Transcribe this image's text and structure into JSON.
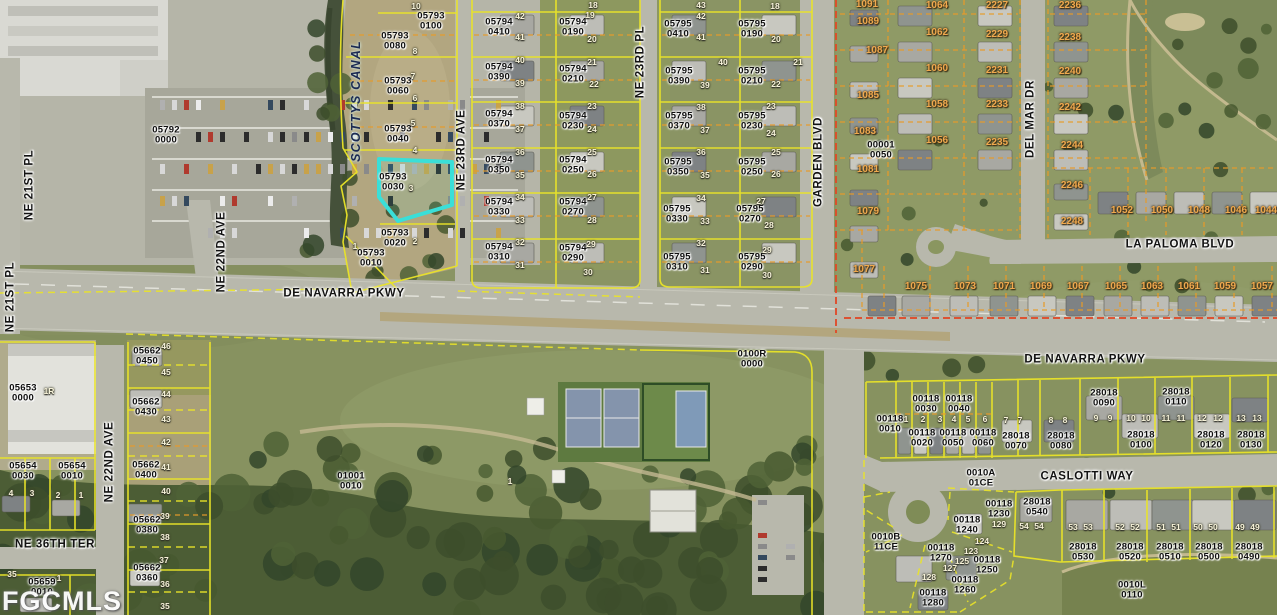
{
  "watermark": "FGCMLS",
  "highlighted_parcel": {
    "id": "05793 0030",
    "color": "#3adfd8"
  },
  "streets": [
    {
      "name": "NE 21ST PL",
      "x": 30,
      "y": 185,
      "rot": -90
    },
    {
      "name": "NE 21ST PL",
      "x": 11,
      "y": 297,
      "rot": -90
    },
    {
      "name": "NE 22ND AVE",
      "x": 222,
      "y": 252,
      "rot": -90
    },
    {
      "name": "NE 22ND AVE",
      "x": 110,
      "y": 462,
      "rot": -90
    },
    {
      "name": "NE 23RD AVE",
      "x": 462,
      "y": 150,
      "rot": -90
    },
    {
      "name": "NE 23RD PL",
      "x": 641,
      "y": 62,
      "rot": -90
    },
    {
      "name": "GARDEN BLVD",
      "x": 819,
      "y": 162,
      "rot": -90
    },
    {
      "name": "DEL MAR DR",
      "x": 1031,
      "y": 119,
      "rot": -90
    },
    {
      "name": "SCOTTYS CANAL",
      "x": 356,
      "y": 101,
      "rot": -90,
      "style": "canal"
    },
    {
      "name": "DE NAVARRA PKWY",
      "x": 344,
      "y": 294,
      "rot": 0
    },
    {
      "name": "DE NAVARRA PKWY",
      "x": 1085,
      "y": 360,
      "rot": 0
    },
    {
      "name": "LA PALOMA BLVD",
      "x": 1180,
      "y": 245,
      "rot": 0
    },
    {
      "name": "CASLOTTI WAY",
      "x": 1087,
      "y": 477,
      "rot": 0
    },
    {
      "name": "NE 36TH TER",
      "x": 55,
      "y": 545,
      "rot": 0
    }
  ],
  "parcels": [
    {
      "id": "05792 0000",
      "x": 166,
      "y": 135
    },
    {
      "id": "05793 0100",
      "x": 431,
      "y": 21
    },
    {
      "id": "05793 0080",
      "x": 395,
      "y": 41
    },
    {
      "id": "05793 0060",
      "x": 398,
      "y": 86
    },
    {
      "id": "05793 0040",
      "x": 398,
      "y": 134
    },
    {
      "id": "05793 0030",
      "x": 393,
      "y": 182
    },
    {
      "id": "05793 0020",
      "x": 395,
      "y": 238
    },
    {
      "id": "05793 0010",
      "x": 371,
      "y": 258
    },
    {
      "id": "05794 0410",
      "x": 499,
      "y": 27
    },
    {
      "id": "05794 0390",
      "x": 499,
      "y": 72
    },
    {
      "id": "05794 0370",
      "x": 499,
      "y": 119
    },
    {
      "id": "05794 0350",
      "x": 499,
      "y": 165
    },
    {
      "id": "05794 0330",
      "x": 499,
      "y": 207
    },
    {
      "id": "05794 0310",
      "x": 499,
      "y": 252
    },
    {
      "id": "05794 0190",
      "x": 573,
      "y": 27
    },
    {
      "id": "05794 0210",
      "x": 573,
      "y": 74
    },
    {
      "id": "05794 0230",
      "x": 573,
      "y": 121
    },
    {
      "id": "05794 0250",
      "x": 573,
      "y": 165
    },
    {
      "id": "05794 0270",
      "x": 573,
      "y": 207
    },
    {
      "id": "05794 0290",
      "x": 573,
      "y": 253
    },
    {
      "id": "05795 0410",
      "x": 678,
      "y": 29
    },
    {
      "id": "05795 0390",
      "x": 679,
      "y": 76
    },
    {
      "id": "05795 0370",
      "x": 679,
      "y": 121
    },
    {
      "id": "05795 0350",
      "x": 678,
      "y": 167
    },
    {
      "id": "05795 0330",
      "x": 677,
      "y": 214
    },
    {
      "id": "05795 0310",
      "x": 677,
      "y": 262
    },
    {
      "id": "05795 0190",
      "x": 752,
      "y": 29
    },
    {
      "id": "05795 0210",
      "x": 752,
      "y": 76
    },
    {
      "id": "05795 0230",
      "x": 752,
      "y": 121
    },
    {
      "id": "05795 0250",
      "x": 752,
      "y": 167
    },
    {
      "id": "05795 0270",
      "x": 750,
      "y": 214
    },
    {
      "id": "05795 0290",
      "x": 752,
      "y": 262
    },
    {
      "id": "00001 0050",
      "x": 881,
      "y": 150
    },
    {
      "id": "0100R 0000",
      "x": 752,
      "y": 359
    },
    {
      "id": "01001 0010",
      "x": 351,
      "y": 481
    },
    {
      "id": "05662 0450",
      "x": 147,
      "y": 356
    },
    {
      "id": "05662 0430",
      "x": 146,
      "y": 407
    },
    {
      "id": "05662 0400",
      "x": 146,
      "y": 470
    },
    {
      "id": "05662 0380",
      "x": 147,
      "y": 525
    },
    {
      "id": "05662 0360",
      "x": 147,
      "y": 573
    },
    {
      "id": "05653 0000",
      "x": 23,
      "y": 393
    },
    {
      "id": "05654 0030",
      "x": 23,
      "y": 471
    },
    {
      "id": "05654 0010",
      "x": 72,
      "y": 471
    },
    {
      "id": "05659 0010",
      "x": 42,
      "y": 587
    },
    {
      "id": "00118 0010",
      "x": 890,
      "y": 424
    },
    {
      "id": "00118 0030",
      "x": 926,
      "y": 404
    },
    {
      "id": "00118 0040",
      "x": 959,
      "y": 404
    },
    {
      "id": "00118 0020",
      "x": 922,
      "y": 438
    },
    {
      "id": "00118 0050",
      "x": 953,
      "y": 438
    },
    {
      "id": "00118 0060",
      "x": 983,
      "y": 438
    },
    {
      "id": "28018 0070",
      "x": 1016,
      "y": 441
    },
    {
      "id": "28018 0080",
      "x": 1061,
      "y": 441
    },
    {
      "id": "28018 0090",
      "x": 1104,
      "y": 398
    },
    {
      "id": "28018 0100",
      "x": 1141,
      "y": 440
    },
    {
      "id": "28018 0110",
      "x": 1176,
      "y": 397
    },
    {
      "id": "28018 0120",
      "x": 1211,
      "y": 440
    },
    {
      "id": "28018 0130",
      "x": 1251,
      "y": 440
    },
    {
      "id": "0010A 01CE",
      "x": 981,
      "y": 478
    },
    {
      "id": "0010B 11CE",
      "x": 886,
      "y": 542
    },
    {
      "id": "00118 1230",
      "x": 999,
      "y": 509
    },
    {
      "id": "28018 0540",
      "x": 1037,
      "y": 507
    },
    {
      "id": "00118 1240",
      "x": 967,
      "y": 525
    },
    {
      "id": "00118 1270",
      "x": 941,
      "y": 553
    },
    {
      "id": "00118 1250",
      "x": 987,
      "y": 565
    },
    {
      "id": "00118 1260",
      "x": 965,
      "y": 585
    },
    {
      "id": "00118 1280",
      "x": 933,
      "y": 598
    },
    {
      "id": "28018 0530",
      "x": 1083,
      "y": 552
    },
    {
      "id": "28018 0520",
      "x": 1130,
      "y": 552
    },
    {
      "id": "28018 0510",
      "x": 1170,
      "y": 552
    },
    {
      "id": "28018 0500",
      "x": 1209,
      "y": 552
    },
    {
      "id": "28018 0490",
      "x": 1249,
      "y": 552
    },
    {
      "id": "0010L 0110",
      "x": 1132,
      "y": 590
    }
  ],
  "house_numbers": [
    {
      "n": "1091",
      "x": 867,
      "y": 5
    },
    {
      "n": "1089",
      "x": 868,
      "y": 22
    },
    {
      "n": "1087",
      "x": 877,
      "y": 51
    },
    {
      "n": "1085",
      "x": 868,
      "y": 96
    },
    {
      "n": "1083",
      "x": 865,
      "y": 132
    },
    {
      "n": "1081",
      "x": 868,
      "y": 170
    },
    {
      "n": "1079",
      "x": 868,
      "y": 212
    },
    {
      "n": "1077",
      "x": 864,
      "y": 270
    },
    {
      "n": "1075",
      "x": 916,
      "y": 287
    },
    {
      "n": "1073",
      "x": 965,
      "y": 287
    },
    {
      "n": "1071",
      "x": 1004,
      "y": 287
    },
    {
      "n": "1069",
      "x": 1041,
      "y": 287
    },
    {
      "n": "1067",
      "x": 1078,
      "y": 287
    },
    {
      "n": "1065",
      "x": 1116,
      "y": 287
    },
    {
      "n": "1063",
      "x": 1152,
      "y": 287
    },
    {
      "n": "1061",
      "x": 1189,
      "y": 287
    },
    {
      "n": "1059",
      "x": 1225,
      "y": 287
    },
    {
      "n": "1057",
      "x": 1262,
      "y": 287
    },
    {
      "n": "1064",
      "x": 937,
      "y": 6
    },
    {
      "n": "1062",
      "x": 937,
      "y": 33
    },
    {
      "n": "1060",
      "x": 937,
      "y": 69
    },
    {
      "n": "1058",
      "x": 937,
      "y": 105
    },
    {
      "n": "1056",
      "x": 937,
      "y": 141
    },
    {
      "n": "2227",
      "x": 997,
      "y": 6
    },
    {
      "n": "2229",
      "x": 997,
      "y": 35
    },
    {
      "n": "2231",
      "x": 997,
      "y": 71
    },
    {
      "n": "2233",
      "x": 997,
      "y": 105
    },
    {
      "n": "2235",
      "x": 997,
      "y": 143
    },
    {
      "n": "2236",
      "x": 1070,
      "y": 6
    },
    {
      "n": "2238",
      "x": 1070,
      "y": 38
    },
    {
      "n": "2240",
      "x": 1070,
      "y": 72
    },
    {
      "n": "2242",
      "x": 1070,
      "y": 108
    },
    {
      "n": "2244",
      "x": 1072,
      "y": 146
    },
    {
      "n": "2246",
      "x": 1072,
      "y": 186
    },
    {
      "n": "2248",
      "x": 1072,
      "y": 222
    },
    {
      "n": "1052",
      "x": 1122,
      "y": 211
    },
    {
      "n": "1050",
      "x": 1162,
      "y": 211
    },
    {
      "n": "1048",
      "x": 1199,
      "y": 211
    },
    {
      "n": "1046",
      "x": 1236,
      "y": 211
    },
    {
      "n": "1044",
      "x": 1266,
      "y": 211
    }
  ],
  "lot_numbers": [
    {
      "n": "10",
      "x": 416,
      "y": 6
    },
    {
      "n": "8",
      "x": 415,
      "y": 51
    },
    {
      "n": "7",
      "x": 413,
      "y": 76
    },
    {
      "n": "6",
      "x": 415,
      "y": 98
    },
    {
      "n": "5",
      "x": 413,
      "y": 123
    },
    {
      "n": "4",
      "x": 415,
      "y": 150
    },
    {
      "n": "3",
      "x": 411,
      "y": 188
    },
    {
      "n": "2",
      "x": 415,
      "y": 241
    },
    {
      "n": "1",
      "x": 355,
      "y": 246
    },
    {
      "n": "42",
      "x": 520,
      "y": 16
    },
    {
      "n": "41",
      "x": 520,
      "y": 37
    },
    {
      "n": "40",
      "x": 520,
      "y": 60
    },
    {
      "n": "39",
      "x": 520,
      "y": 83
    },
    {
      "n": "38",
      "x": 520,
      "y": 106
    },
    {
      "n": "37",
      "x": 520,
      "y": 129
    },
    {
      "n": "36",
      "x": 520,
      "y": 152
    },
    {
      "n": "35",
      "x": 520,
      "y": 175
    },
    {
      "n": "34",
      "x": 520,
      "y": 197
    },
    {
      "n": "33",
      "x": 520,
      "y": 220
    },
    {
      "n": "32",
      "x": 520,
      "y": 242
    },
    {
      "n": "31",
      "x": 520,
      "y": 265
    },
    {
      "n": "18",
      "x": 593,
      "y": 5
    },
    {
      "n": "19",
      "x": 590,
      "y": 15
    },
    {
      "n": "20",
      "x": 592,
      "y": 39
    },
    {
      "n": "21",
      "x": 592,
      "y": 62
    },
    {
      "n": "22",
      "x": 594,
      "y": 84
    },
    {
      "n": "23",
      "x": 592,
      "y": 106
    },
    {
      "n": "24",
      "x": 592,
      "y": 129
    },
    {
      "n": "25",
      "x": 592,
      "y": 152
    },
    {
      "n": "26",
      "x": 592,
      "y": 174
    },
    {
      "n": "27",
      "x": 592,
      "y": 197
    },
    {
      "n": "28",
      "x": 592,
      "y": 220
    },
    {
      "n": "29",
      "x": 591,
      "y": 244
    },
    {
      "n": "30",
      "x": 588,
      "y": 272
    },
    {
      "n": "43",
      "x": 701,
      "y": 5
    },
    {
      "n": "42",
      "x": 701,
      "y": 16
    },
    {
      "n": "41",
      "x": 701,
      "y": 37
    },
    {
      "n": "40",
      "x": 723,
      "y": 62
    },
    {
      "n": "39",
      "x": 705,
      "y": 85
    },
    {
      "n": "38",
      "x": 701,
      "y": 107
    },
    {
      "n": "37",
      "x": 705,
      "y": 130
    },
    {
      "n": "36",
      "x": 701,
      "y": 152
    },
    {
      "n": "35",
      "x": 705,
      "y": 175
    },
    {
      "n": "34",
      "x": 701,
      "y": 198
    },
    {
      "n": "33",
      "x": 705,
      "y": 221
    },
    {
      "n": "32",
      "x": 701,
      "y": 243
    },
    {
      "n": "31",
      "x": 705,
      "y": 270
    },
    {
      "n": "18",
      "x": 775,
      "y": 6
    },
    {
      "n": "20",
      "x": 776,
      "y": 39
    },
    {
      "n": "21",
      "x": 798,
      "y": 62
    },
    {
      "n": "22",
      "x": 776,
      "y": 84
    },
    {
      "n": "23",
      "x": 771,
      "y": 106
    },
    {
      "n": "24",
      "x": 771,
      "y": 133
    },
    {
      "n": "25",
      "x": 776,
      "y": 152
    },
    {
      "n": "26",
      "x": 776,
      "y": 174
    },
    {
      "n": "27",
      "x": 761,
      "y": 201
    },
    {
      "n": "28",
      "x": 769,
      "y": 225
    },
    {
      "n": "29",
      "x": 767,
      "y": 250
    },
    {
      "n": "30",
      "x": 767,
      "y": 275
    },
    {
      "n": "46",
      "x": 166,
      "y": 346
    },
    {
      "n": "45",
      "x": 166,
      "y": 372
    },
    {
      "n": "44",
      "x": 166,
      "y": 394
    },
    {
      "n": "43",
      "x": 166,
      "y": 419
    },
    {
      "n": "42",
      "x": 166,
      "y": 442
    },
    {
      "n": "41",
      "x": 166,
      "y": 467
    },
    {
      "n": "40",
      "x": 166,
      "y": 491
    },
    {
      "n": "39",
      "x": 165,
      "y": 516
    },
    {
      "n": "38",
      "x": 165,
      "y": 537
    },
    {
      "n": "37",
      "x": 164,
      "y": 560
    },
    {
      "n": "36",
      "x": 165,
      "y": 584
    },
    {
      "n": "35",
      "x": 165,
      "y": 606
    },
    {
      "n": "1R",
      "x": 49,
      "y": 391
    },
    {
      "n": "4",
      "x": 11,
      "y": 493
    },
    {
      "n": "3",
      "x": 32,
      "y": 493
    },
    {
      "n": "2",
      "x": 58,
      "y": 495
    },
    {
      "n": "1",
      "x": 81,
      "y": 495
    },
    {
      "n": "35",
      "x": 12,
      "y": 574
    },
    {
      "n": "1",
      "x": 59,
      "y": 578
    },
    {
      "n": "1",
      "x": 510,
      "y": 481
    },
    {
      "n": "1",
      "x": 906,
      "y": 419
    },
    {
      "n": "2",
      "x": 923,
      "y": 419
    },
    {
      "n": "3",
      "x": 940,
      "y": 419
    },
    {
      "n": "4",
      "x": 954,
      "y": 419
    },
    {
      "n": "5",
      "x": 968,
      "y": 419
    },
    {
      "n": "6",
      "x": 985,
      "y": 419
    },
    {
      "n": "7",
      "x": 1006,
      "y": 420
    },
    {
      "n": "7",
      "x": 1020,
      "y": 420
    },
    {
      "n": "8",
      "x": 1051,
      "y": 420
    },
    {
      "n": "8",
      "x": 1065,
      "y": 420
    },
    {
      "n": "9",
      "x": 1096,
      "y": 418
    },
    {
      "n": "9",
      "x": 1110,
      "y": 418
    },
    {
      "n": "10",
      "x": 1131,
      "y": 418
    },
    {
      "n": "10",
      "x": 1146,
      "y": 418
    },
    {
      "n": "11",
      "x": 1166,
      "y": 418
    },
    {
      "n": "11",
      "x": 1181,
      "y": 418
    },
    {
      "n": "12",
      "x": 1202,
      "y": 418
    },
    {
      "n": "12",
      "x": 1218,
      "y": 418
    },
    {
      "n": "13",
      "x": 1241,
      "y": 418
    },
    {
      "n": "13",
      "x": 1257,
      "y": 418
    },
    {
      "n": "54",
      "x": 1024,
      "y": 526
    },
    {
      "n": "54",
      "x": 1039,
      "y": 526
    },
    {
      "n": "53",
      "x": 1073,
      "y": 527
    },
    {
      "n": "53",
      "x": 1088,
      "y": 527
    },
    {
      "n": "52",
      "x": 1120,
      "y": 527
    },
    {
      "n": "52",
      "x": 1135,
      "y": 527
    },
    {
      "n": "51",
      "x": 1161,
      "y": 527
    },
    {
      "n": "51",
      "x": 1176,
      "y": 527
    },
    {
      "n": "50",
      "x": 1198,
      "y": 527
    },
    {
      "n": "50",
      "x": 1213,
      "y": 527
    },
    {
      "n": "49",
      "x": 1240,
      "y": 527
    },
    {
      "n": "49",
      "x": 1255,
      "y": 527
    },
    {
      "n": "129",
      "x": 999,
      "y": 524
    },
    {
      "n": "124",
      "x": 982,
      "y": 541
    },
    {
      "n": "123",
      "x": 971,
      "y": 551
    },
    {
      "n": "125",
      "x": 962,
      "y": 561
    },
    {
      "n": "127",
      "x": 950,
      "y": 568
    },
    {
      "n": "128",
      "x": 929,
      "y": 577
    }
  ]
}
